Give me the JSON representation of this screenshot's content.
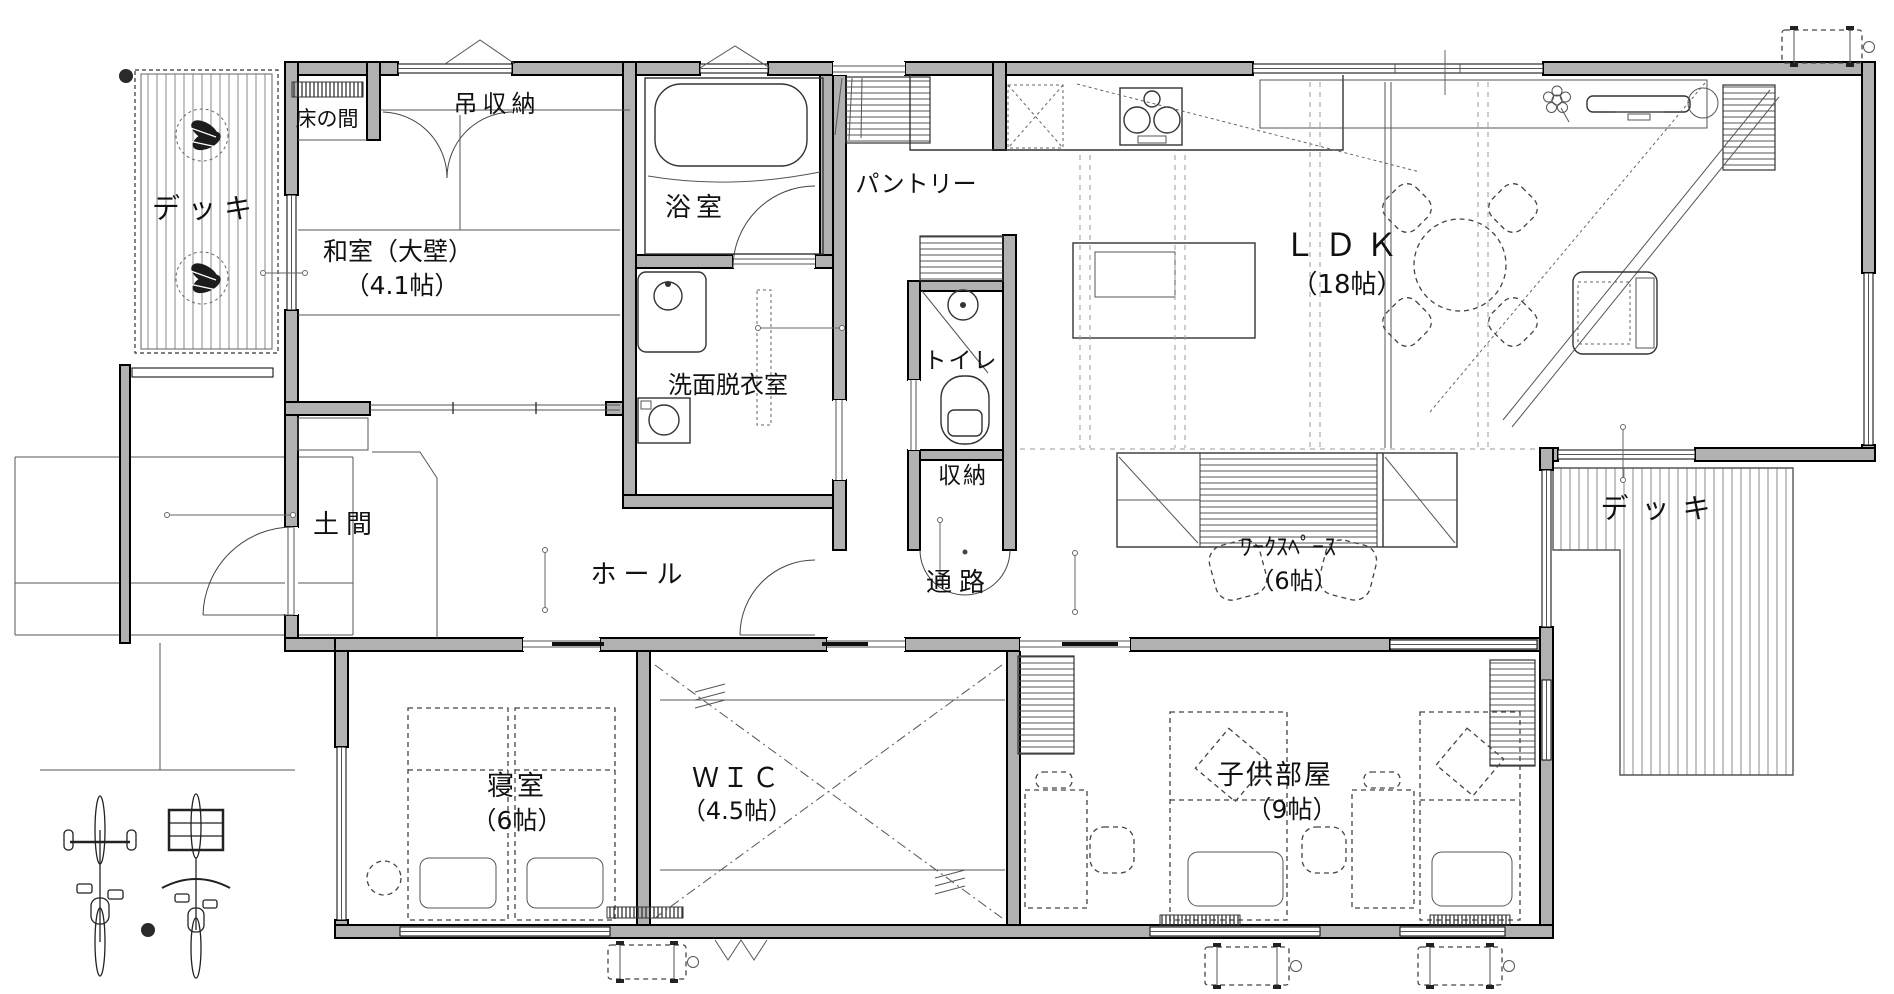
{
  "plan": {
    "kind": "japanese-house-floor-plan",
    "background": "#ffffff"
  },
  "colors": {
    "wall_fill": "#b1b1b1",
    "wall_stroke": "#000000",
    "line": "#333333",
    "text": "#111111"
  },
  "rooms": {
    "deck_left": {
      "label": "デッキ"
    },
    "tokonoma": {
      "label": "床の間"
    },
    "hanging_storage": {
      "label": "吊収納"
    },
    "washitsu": {
      "label": "和室（大壁）",
      "size": "（4.1帖）"
    },
    "bathroom": {
      "label": "浴室"
    },
    "washroom": {
      "label": "洗面脱衣室"
    },
    "pantry": {
      "label": "パントリー"
    },
    "toilet": {
      "label": "トイレ"
    },
    "storage": {
      "label": "収納"
    },
    "doma": {
      "label": "土間"
    },
    "hall": {
      "label": "ホール"
    },
    "passage": {
      "label": "通路"
    },
    "ldk": {
      "label": "ＬＤＫ",
      "size": "（18帖）"
    },
    "workspace": {
      "label": "ﾜｰｸｽﾍﾟｰｽ",
      "size": "（6帖）"
    },
    "deck_right": {
      "label": "デッキ"
    },
    "bedroom": {
      "label": "寝室",
      "size": "（6帖）"
    },
    "wic": {
      "label": "ＷＩＣ",
      "size": "（4.5帖）"
    },
    "kids_room": {
      "label": "子供部屋",
      "size": "（9帖）"
    }
  },
  "icons": {
    "bathtub": "rounded-rect",
    "toilet": "rounded-bowl",
    "washbasin": "square-with-circle",
    "washing_machine": "square-with-circle",
    "stove": "three-burners",
    "dining_table": "dashed-circle",
    "sofa": "rounded-rect",
    "tv_board": "long-rect",
    "plant": "petal-cluster",
    "bed": "dashed-rect-with-pillow",
    "bicycle": "top-view-bike",
    "ac_outdoor_unit": "dashed-rect-with-feet"
  }
}
